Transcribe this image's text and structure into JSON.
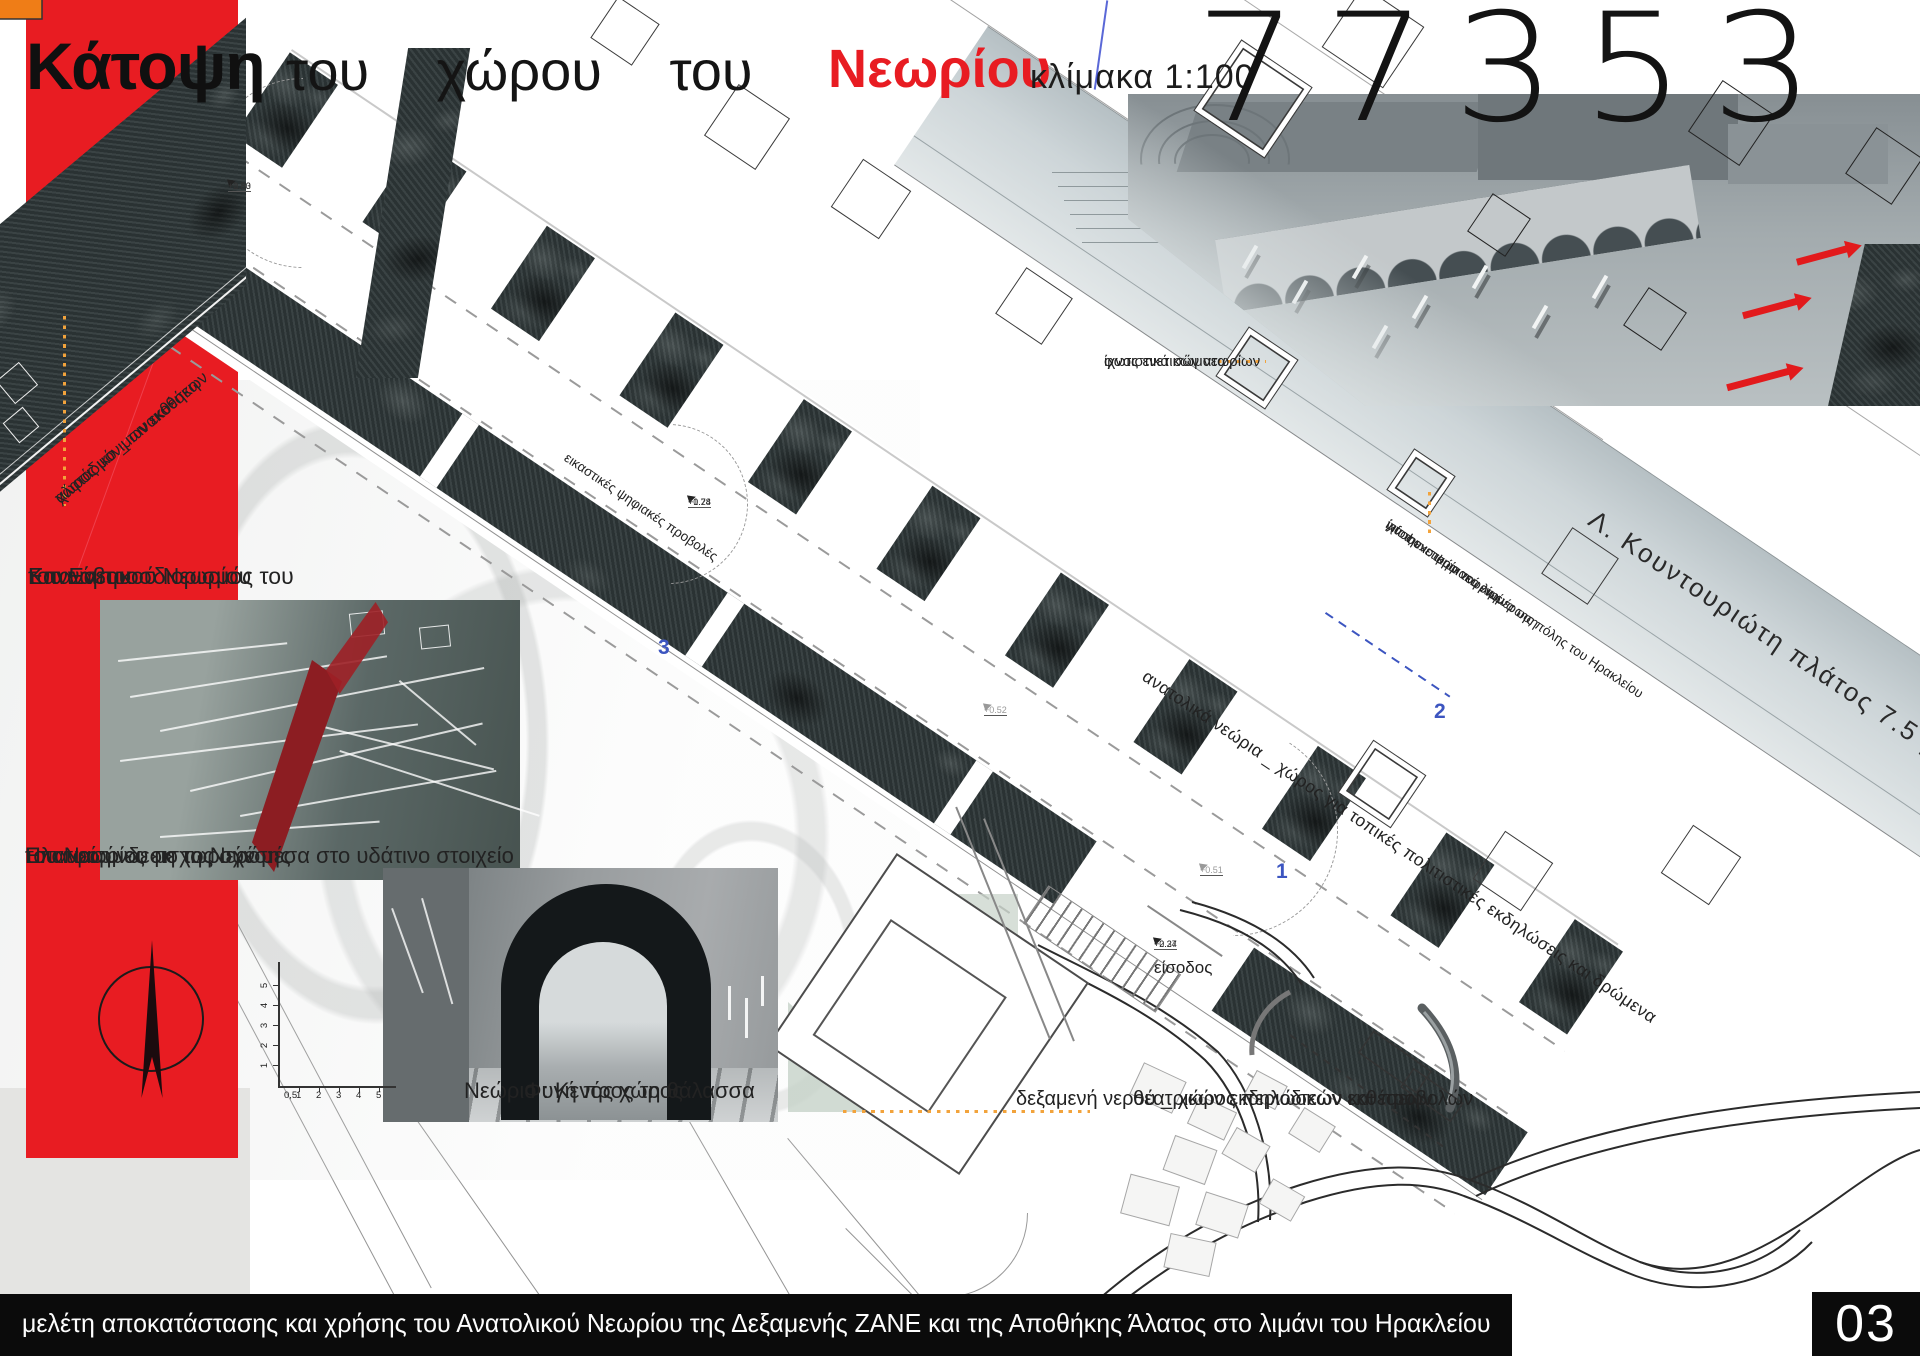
{
  "title": {
    "kataopsi": "Κάτοψη",
    "middle": "του χώρου του",
    "neoriou": "Νεωρίου",
    "scale": "κλίμακα 1:100",
    "number": "77353"
  },
  "annotations": {
    "salt1": "αλατάδικο _ πινακοθήκη",
    "salt2": "χώρος μόνιμων εκθέσεων",
    "regrid1": "Επαναπροσδιορισμός του",
    "regrid2": "Καννάβου",
    "regrid3": "του Ενετικού Νεωρίου",
    "reconnect1": "Επανασύνδεση της σχέσης",
    "reconnect2": "του Νεωρίου με το Νερό :",
    "reconnect3": "Πλατφόρμες εισχωρούν μέσα στο υδάτινο στοιχείο",
    "projections": "εικαστικές ψηφιακές προβολές",
    "lighting1": "ίχνος ενετικών νεωρίων",
    "lighting2": "φωτιστικά σώματα",
    "infobox1": "ίχνος ενετικών νεωρίων",
    "infobox2": "info box : ψηφιακή ενημέρωση",
    "infobox3": "για την ιστορία του λιμένα της πόλης του Ηρακλείου",
    "street": "Λ. Κουντουριώτη  πλάτος 7.5 μ.",
    "east": "ανατολικά νεώρια _ χώρος για τοπικές πολιτιστικές εκδηλώσεις και δρώμενα",
    "empty1": "Νεώριο : Κενός χώρος",
    "empty2": "Φυγή προς τη θάλασσα",
    "entrance": "είσοδος",
    "tank1": "δεξαμενή νερού _ χώρος περιοδικών εκθέσεων",
    "tank2": "θεατρικών εκδηλώσεων και προβολών"
  },
  "markers": {
    "m1_top": "+1.80",
    "m1_bottom": "+0.53",
    "m2_top": "+0.78",
    "m2_bottom": "+1.24",
    "m3_top": "+0.24",
    "m3_bottom": "+2.37",
    "m4": "+0.52",
    "m5": "+0.51"
  },
  "sections": {
    "s1": "1",
    "s2": "2",
    "s3": "3"
  },
  "scalebar": {
    "y1": "1",
    "y2": "2",
    "y3": "3",
    "y4": "4",
    "y5": "5",
    "x0": "0,5",
    "x1": "1",
    "x2": "2",
    "x3": "3",
    "x4": "4",
    "x5": "5"
  },
  "footer": {
    "study": "μελέτη αποκατάστασης και χρήσης του Ανατολικού Νεωρίου της Δεξαμενής ΖΑΝΕ και της Αποθήκης Άλατος στο λιμάνι του Ηρακλείου",
    "page": "03"
  },
  "colors": {
    "red": "#e81c22",
    "orange": "#ef7d17",
    "dot_orange": "#f2a33c",
    "blue": "#3c55c0",
    "stone": "#30393a"
  }
}
